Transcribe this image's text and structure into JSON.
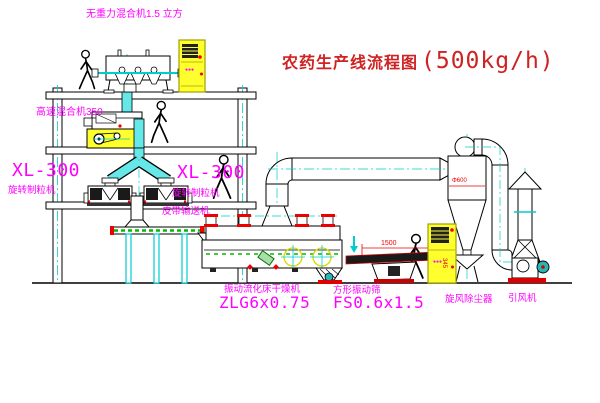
{
  "title": {
    "main": "农药生产线流程图",
    "capacity": "(500kg/h)"
  },
  "labels": {
    "gravity_mixer": "无重力混合机1.5 立方",
    "hs_mixer": "高速混合机350",
    "xl300_left": "XL-300",
    "granulator_left": "旋转制粒机",
    "xl300_right": "XL-300",
    "granulator_right": "旋转制粒机",
    "belt_conveyor": "皮带输送机",
    "dryer_name": "振动流化床干燥机",
    "dryer_model": "ZLG6x0.75",
    "screen_name": "方形振动筛",
    "screen_model": "FS0.6x1.5",
    "cyclone_name": "旋风除尘器",
    "fan_name": "引风机",
    "dim_length": "1500",
    "dim_height": "345",
    "dim_diameter": "Φ600",
    "indicator_a": "●●●",
    "indicator_b": "●●●"
  },
  "colors": {
    "label_magenta": "#ff00ff",
    "title_red": "#cf2222",
    "dimension_red": "#ee0000",
    "cabinet_yellow": "#ffff2e",
    "chute_cyan": "#66e8e8",
    "centerline_cyan": "#00cdcd",
    "belt_green": "#00bb00",
    "line_black": "#000000"
  }
}
